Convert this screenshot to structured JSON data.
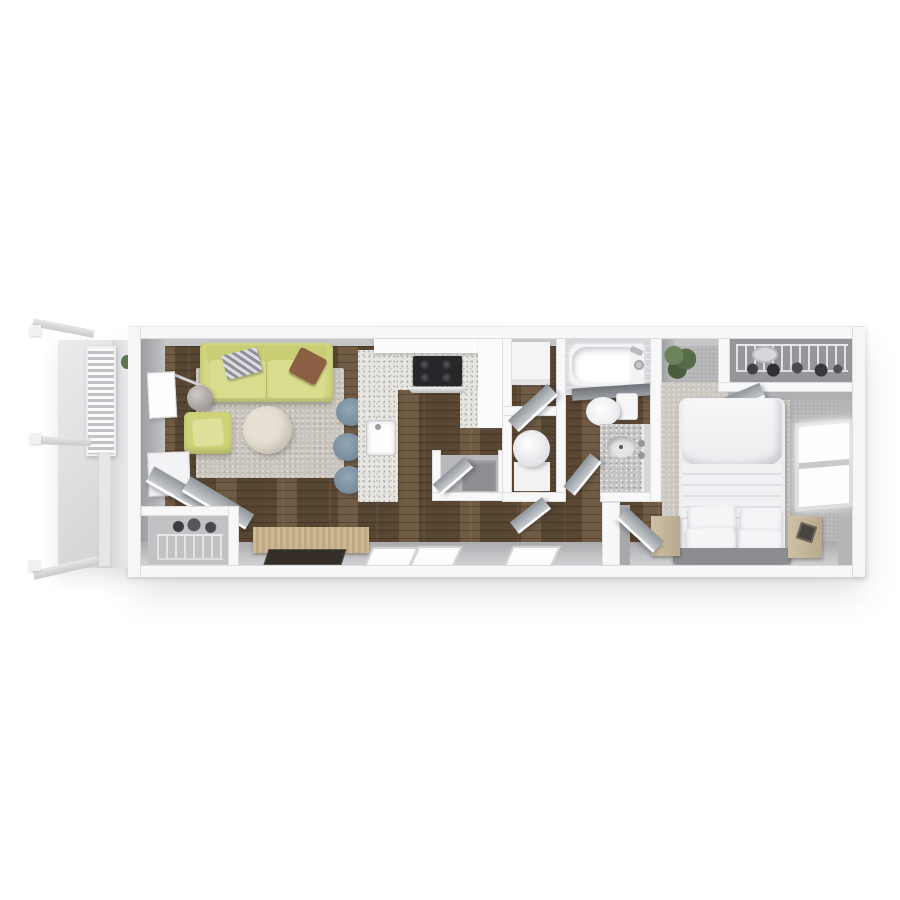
{
  "scene": {
    "type": "3d-rendered-floor-plan-top-view",
    "unit": "one-bedroom-one-bath-apartment",
    "visible_text": [],
    "orientation": "long-axis-horizontal, entry porch left, bedroom right"
  },
  "palette": {
    "background": "#ffffff",
    "outer_wall": "#f8f8f9",
    "wall_face": "#aeaeb2",
    "wood_floor": "#6a563f",
    "living_rug": "#c9c5be",
    "sofa": "#d3d783",
    "sofa_shade": "#bcc06c",
    "pillow_brown": "#8a5f44",
    "coffee_table": "#e6e0d4",
    "lamp": "#b5b0ab",
    "console_wood": "#c8b493",
    "tv": "#352e29",
    "stool": "#8195a4",
    "counter": "#e7e5e0",
    "stove": "#27272a",
    "fridge": "#fbfbfc",
    "appliance": "#f4f4f5",
    "water_heater": "#ececee",
    "tub": "#f3f3f5",
    "toilet": "#fcfcfe",
    "vanity": "#c6c4c3",
    "glass_panel": "#7b7f84",
    "bedroom_carpet": "#b2b1b3",
    "bedroom_rug": "#ccc7c0",
    "bed_linen": "#f2f2f4",
    "headboard": "#8d8d91",
    "nightstand": "#c9bb9f",
    "plant": "#5f7450",
    "balcony_floor": "#e0e0e2",
    "door": "#9aa2a8",
    "window": "#fdfdfe"
  },
  "rooms": [
    {
      "name": "entry-porch-balcony",
      "items": [
        "railing-rails-x3",
        "louvered-privacy-screen",
        "concrete-floor",
        "wall-sconce-plant"
      ]
    },
    {
      "name": "living-room",
      "items": [
        "three-seat-sofa",
        "striped-throw-pillow",
        "brown-throw-pillow",
        "floor-lamp",
        "armchair",
        "round-coffee-table",
        "area-rug",
        "media-console",
        "flat-tv",
        "wall-art-x2",
        "entry-double-doors",
        "entry-closet-with-wire-rack-and-shoes"
      ]
    },
    {
      "name": "kitchen",
      "items": [
        "u-shaped-granite-counter",
        "sink",
        "range-stove-4-burners",
        "oven-handle",
        "upper-cabinets",
        "refrigerator",
        "bar-stools-x3",
        "utility-alcove-with-door"
      ]
    },
    {
      "name": "utility-closets",
      "items": [
        "laundry-appliance-closet",
        "water-heater-closet",
        "closet-doors-x2"
      ]
    },
    {
      "name": "bathroom",
      "items": [
        "bathtub-with-fixtures",
        "glass-shower-panel",
        "toilet",
        "granite-vanity-with-sink",
        "mirror-panel",
        "bathroom-door"
      ]
    },
    {
      "name": "bedroom",
      "items": [
        "double-bed-white-linen",
        "pillows-x4",
        "gray-headboard",
        "nightstand-left",
        "nightstand-right",
        "decor-box",
        "area-rug",
        "side-window-two-pane",
        "wire-shelf-closet",
        "closet-door",
        "corner-plant",
        "bedroom-door"
      ]
    },
    {
      "name": "south-wall",
      "items": [
        "window-pair-kitchen",
        "window-hallway"
      ]
    }
  ]
}
